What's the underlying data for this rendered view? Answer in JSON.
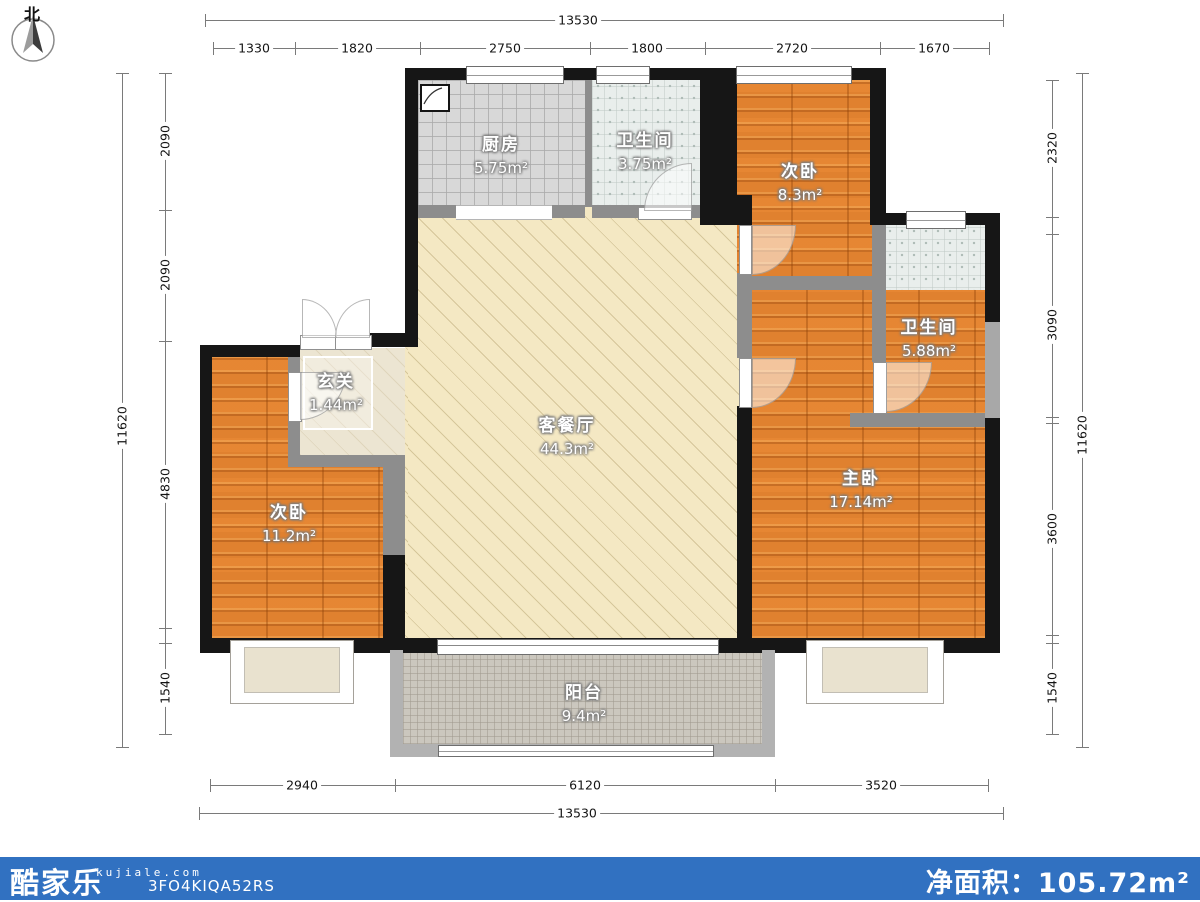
{
  "north_label": "北",
  "rooms": {
    "kitchen": {
      "name": "厨房",
      "area": "5.75m²"
    },
    "bath_top": {
      "name": "卫生间",
      "area": "3.75m²"
    },
    "bedroom_top": {
      "name": "次卧",
      "area": "8.3m²"
    },
    "bath_right": {
      "name": "卫生间",
      "area": "5.88m²"
    },
    "master": {
      "name": "主卧",
      "area": "17.14m²"
    },
    "bedroom_left": {
      "name": "次卧",
      "area": "11.2m²"
    },
    "entry": {
      "name": "玄关",
      "area": "1.44m²"
    },
    "living": {
      "name": "客餐厅",
      "area": "44.3m²"
    },
    "balcony": {
      "name": "阳台",
      "area": "9.4m²"
    }
  },
  "dimensions": {
    "top_total": "13530",
    "top_segments": [
      "1330",
      "1820",
      "2750",
      "1800",
      "2720",
      "1670"
    ],
    "bottom_segments": [
      "2940",
      "6120",
      "3520"
    ],
    "bottom_total": "13530",
    "left_total": "11620",
    "left_segments": [
      "2090",
      "2090",
      "4830",
      "1540"
    ],
    "right_total": "11620",
    "right_segments": [
      "2320",
      "3090",
      "3600",
      "1540"
    ]
  },
  "footer": {
    "brand": "酷家乐",
    "website": "kujiale.com",
    "plan_code": "3FO4KIQA52RS",
    "net_area_label": "净面积：",
    "net_area_value": "105.72m²"
  },
  "colors": {
    "footer_bar": "#3171c1",
    "wall_black": "#161616",
    "wall_gray": "#8d8d8d",
    "wood_floor": "#e0812f",
    "living_floor": "#f4e8c3",
    "tile_floor": "#e9eeec",
    "balcony_floor": "#cbc7be"
  }
}
